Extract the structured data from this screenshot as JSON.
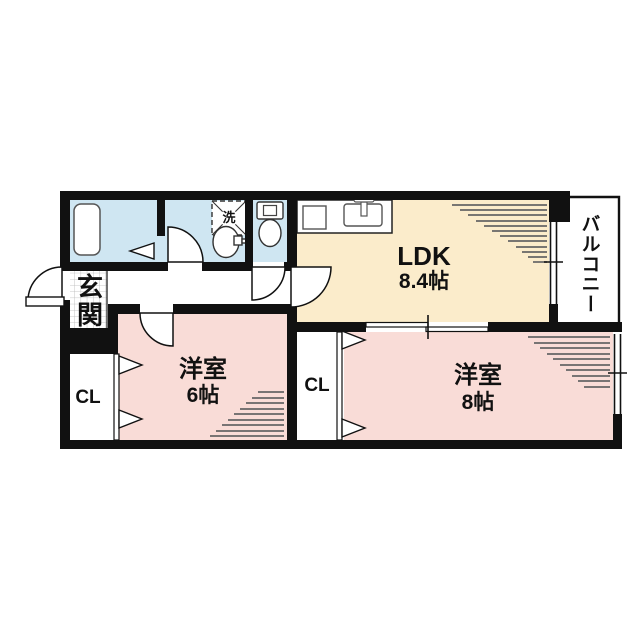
{
  "plan": {
    "rooms": {
      "ldk": {
        "label": "LDK",
        "size": "8.4帖"
      },
      "western6": {
        "label": "洋室",
        "size": "6帖"
      },
      "western8": {
        "label": "洋室",
        "size": "8帖"
      },
      "closet_left": {
        "label": "CL"
      },
      "closet_right": {
        "label": "CL"
      },
      "entrance": {
        "label": "玄関"
      },
      "balcony": {
        "label": "バルコニー"
      },
      "laundry": {
        "label": "洗"
      }
    },
    "icons": [
      "bathtub-icon",
      "washing-machine-icon",
      "vanity-sink-icon",
      "toilet-icon",
      "kitchen-counter-icon",
      "stove-icon",
      "kitchen-sink-icon"
    ],
    "colors": {
      "wall": "#111111",
      "water": "#cfe6f2",
      "ldk": "#fbeccb",
      "room": "#f9dcd7",
      "hatch": "#666666",
      "grid": "#b5b5b5",
      "ink": "#111111"
    }
  }
}
